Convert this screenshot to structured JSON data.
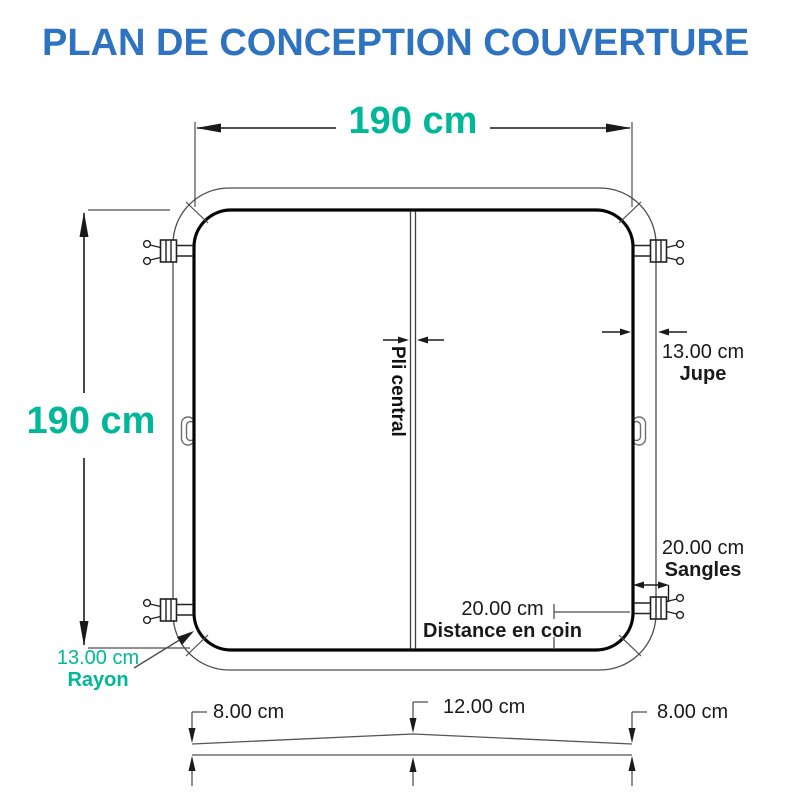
{
  "title": "PLAN DE CONCEPTION COUVERTURE",
  "colors": {
    "title_blue": "#2E72C2",
    "accent_teal": "#00B897",
    "line_dark": "#1A1A1A",
    "line_gray": "#4D4D4D"
  },
  "plan": {
    "width_label": "190 cm",
    "height_label": "190 cm",
    "fold_label": "Pli central",
    "jupe": {
      "value": "13.00 cm",
      "label": "Jupe"
    },
    "sangles": {
      "value": "20.00 cm",
      "label": "Sangles"
    },
    "distance_coin": {
      "value": "20.00 cm",
      "label": "Distance en coin"
    },
    "rayon": {
      "value": "13.00 cm",
      "label": "Rayon"
    }
  },
  "profile": {
    "left": "8.00 cm",
    "center": "12.00 cm",
    "right": "8.00 cm"
  }
}
